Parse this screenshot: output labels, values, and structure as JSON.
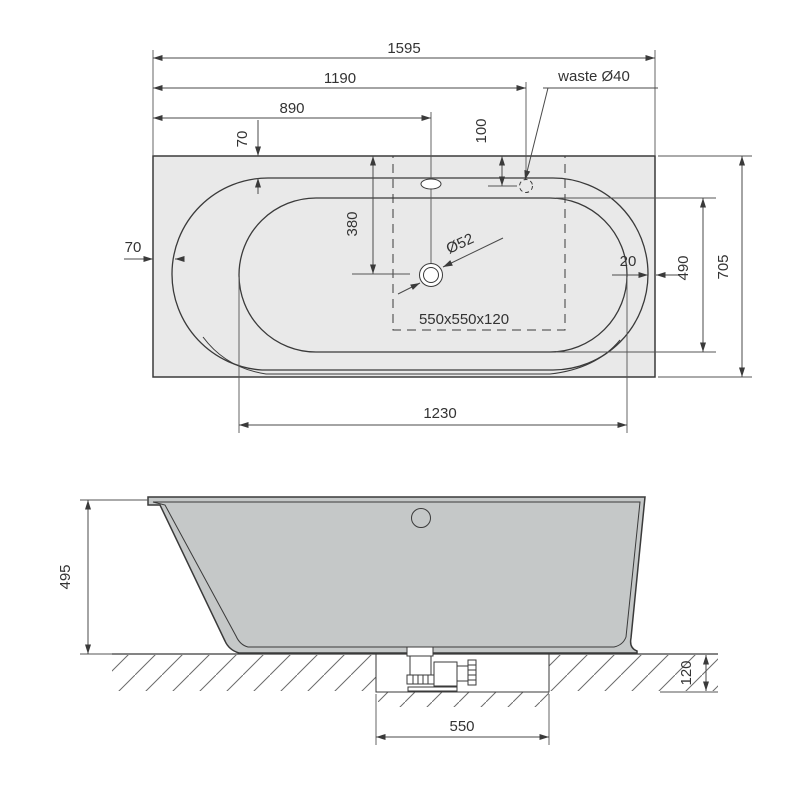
{
  "title": "bathtub-technical-drawing",
  "plan": {
    "overall_length": "1595",
    "waste_from_left": "1190",
    "overflow_from_left": "890",
    "rim_top_offset": "70",
    "waste_from_top": "100",
    "waste_label": "waste Ø40",
    "rim_left_offset": "70",
    "drain_from_top": "380",
    "drain_diameter": "Ø52",
    "recess_size": "550x550x120",
    "rim_right_gap": "20",
    "inner_width": "490",
    "overall_width": "705",
    "inner_length": "1230"
  },
  "elevation": {
    "height": "495",
    "recess_depth": "120",
    "recess_width": "550"
  },
  "colors": {
    "background": "#ffffff",
    "body_fill": "#e9e9e9",
    "wall_fill": "#c5c8c8",
    "line": "#3a3a3a",
    "dim_line": "#4a4a4a",
    "hatch": "#6b6b6b"
  }
}
